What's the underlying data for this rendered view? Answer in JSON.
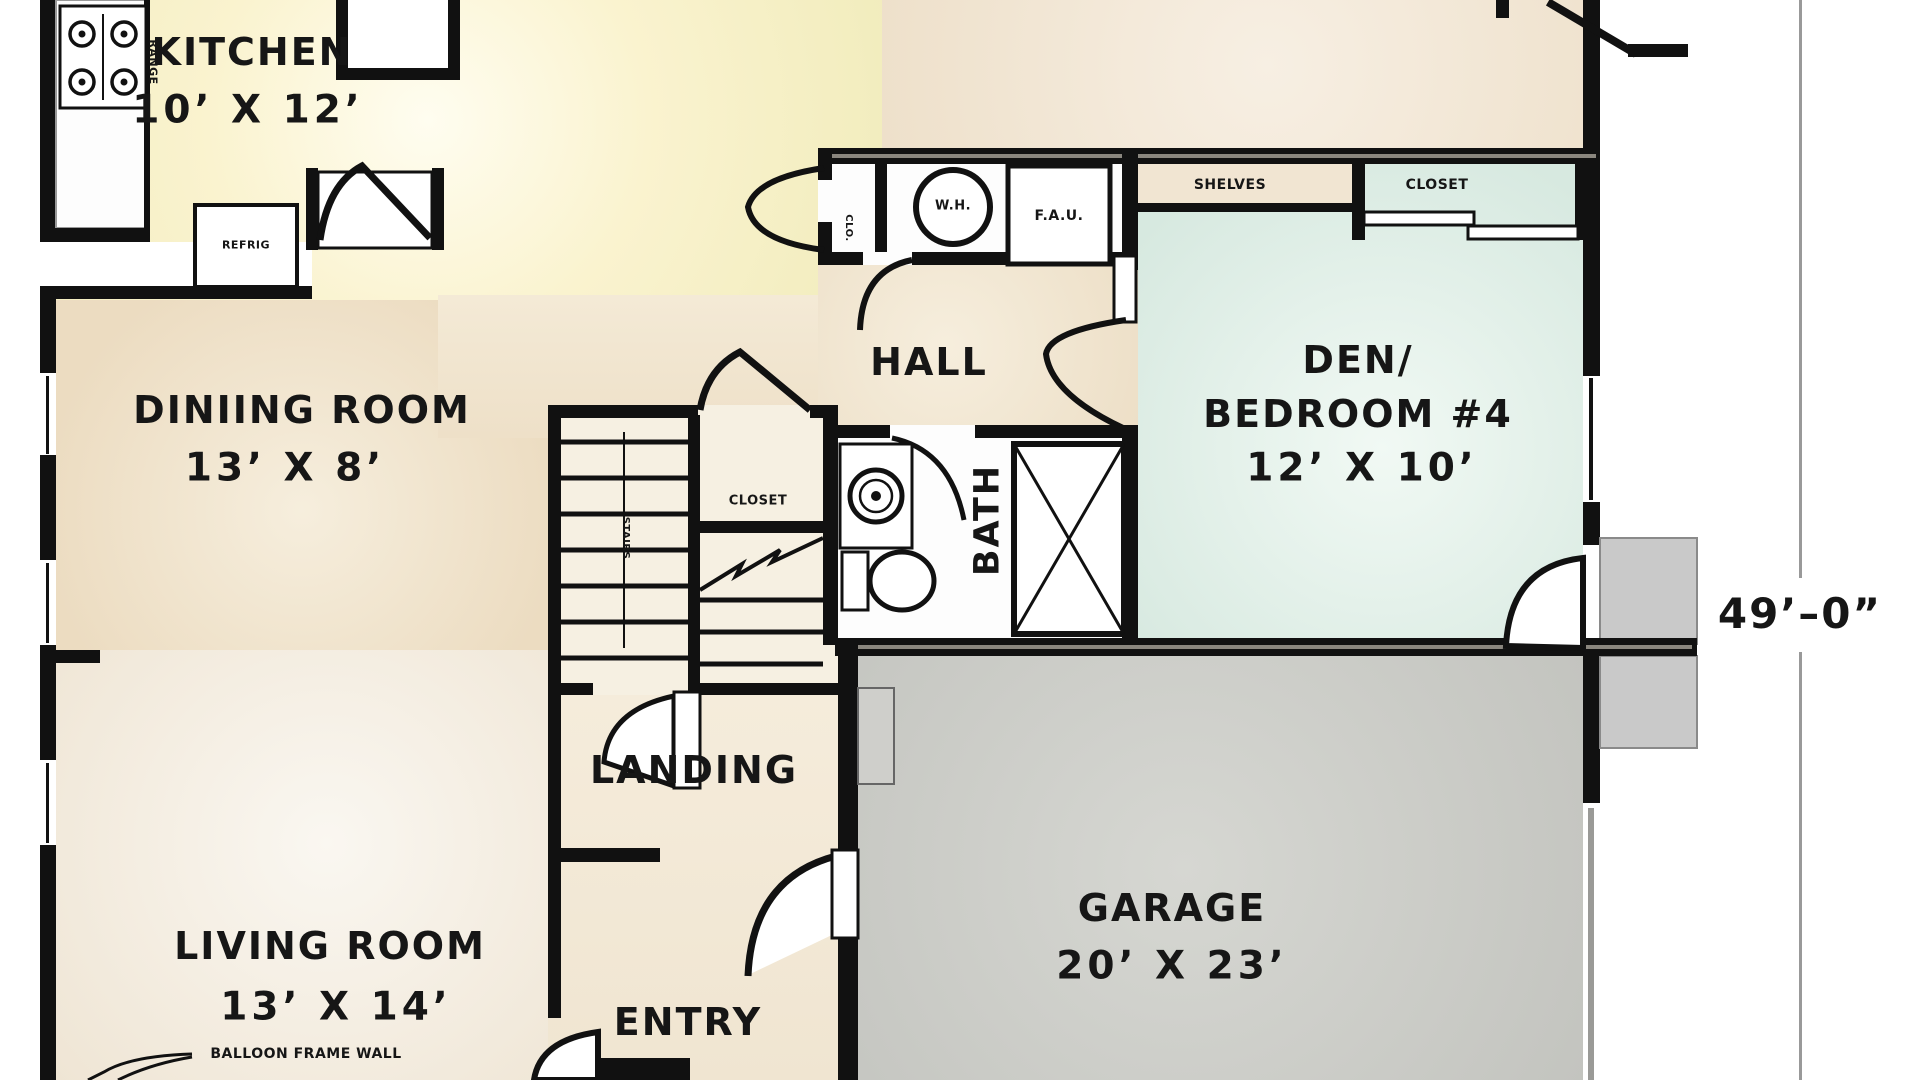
{
  "plan": {
    "dimension": {
      "right_side": "49’–0”"
    },
    "rooms": {
      "kitchen": {
        "name": "KITCHEN",
        "dims": "10’ X 12’"
      },
      "dining": {
        "name": "DINIING ROOM",
        "dims": "13’ X 8’"
      },
      "living": {
        "name": "LIVING ROOM",
        "dims": "13’ X 14’"
      },
      "den": {
        "name_line1": "DEN/",
        "name_line2": "BEDROOM #4",
        "dims": "12’ X 10’"
      },
      "garage": {
        "name": "GARAGE",
        "dims": "20’ X 23’"
      },
      "hall": {
        "name": "HALL"
      },
      "bath": {
        "name": "BATH"
      },
      "entry": {
        "name": "ENTRY"
      },
      "landing": {
        "name": "LANDING"
      },
      "stairs": {
        "name": "STAIRS"
      }
    },
    "labels": {
      "range": "RANGE",
      "refrig": "REFRIG",
      "clo": "CLO.",
      "water_heater": "W.H.",
      "forced_air_unit": "F.A.U.",
      "shelves": "SHELVES",
      "den_closet": "CLOSET",
      "hall_closet": "CLOSET",
      "balloon_note": "BALLOON FRAME WALL"
    },
    "colors": {
      "wall": "#111111",
      "kitchen_fill": "#f7f0c6",
      "tan_fill": "#eedfc5",
      "den_fill": "#dcebe2",
      "garage_fill": "#c8c9c4",
      "stoop_fill": "#c9c9c9",
      "dimension_line": "#999999"
    }
  }
}
